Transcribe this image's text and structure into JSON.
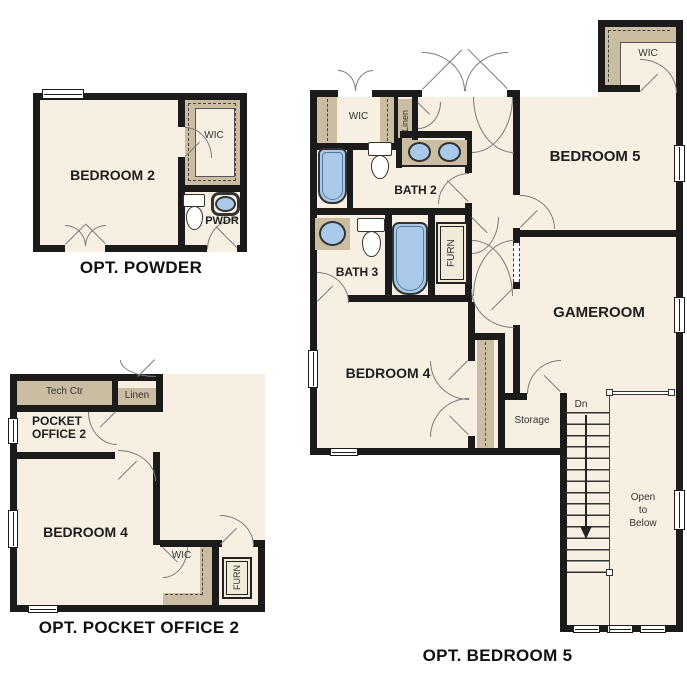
{
  "colors": {
    "wall": "#1b1b1b",
    "floor": "#f7efe2",
    "tan": "#cbbda1",
    "fixture_blue": "#aac9e9"
  },
  "plans": {
    "powder": {
      "caption": "OPT. POWDER",
      "bedroom2": "BEDROOM 2",
      "wic": "WIC",
      "pwdr": "PWDR"
    },
    "pocket_office": {
      "caption": "OPT. POCKET OFFICE 2",
      "tech_ctr": "Tech Ctr",
      "linen": "Linen",
      "office1": "POCKET",
      "office2": "OFFICE 2",
      "bedroom4": "BEDROOM 4",
      "wic": "WIC",
      "furn": "FURN"
    },
    "bedroom5": {
      "caption": "OPT. BEDROOM 5",
      "wic_hall": "WIC",
      "linen": "Linen",
      "bath2": "BATH 2",
      "bedroom5": "BEDROOM 5",
      "wic_bed5": "WIC",
      "bath3": "BATH 3",
      "furn": "FURN",
      "gameroom": "GAMEROOM",
      "bedroom4": "BEDROOM 4",
      "storage": "Storage",
      "dn": "Dn",
      "open_line1": "Open",
      "open_line2": "to",
      "open_line3": "Below"
    }
  }
}
